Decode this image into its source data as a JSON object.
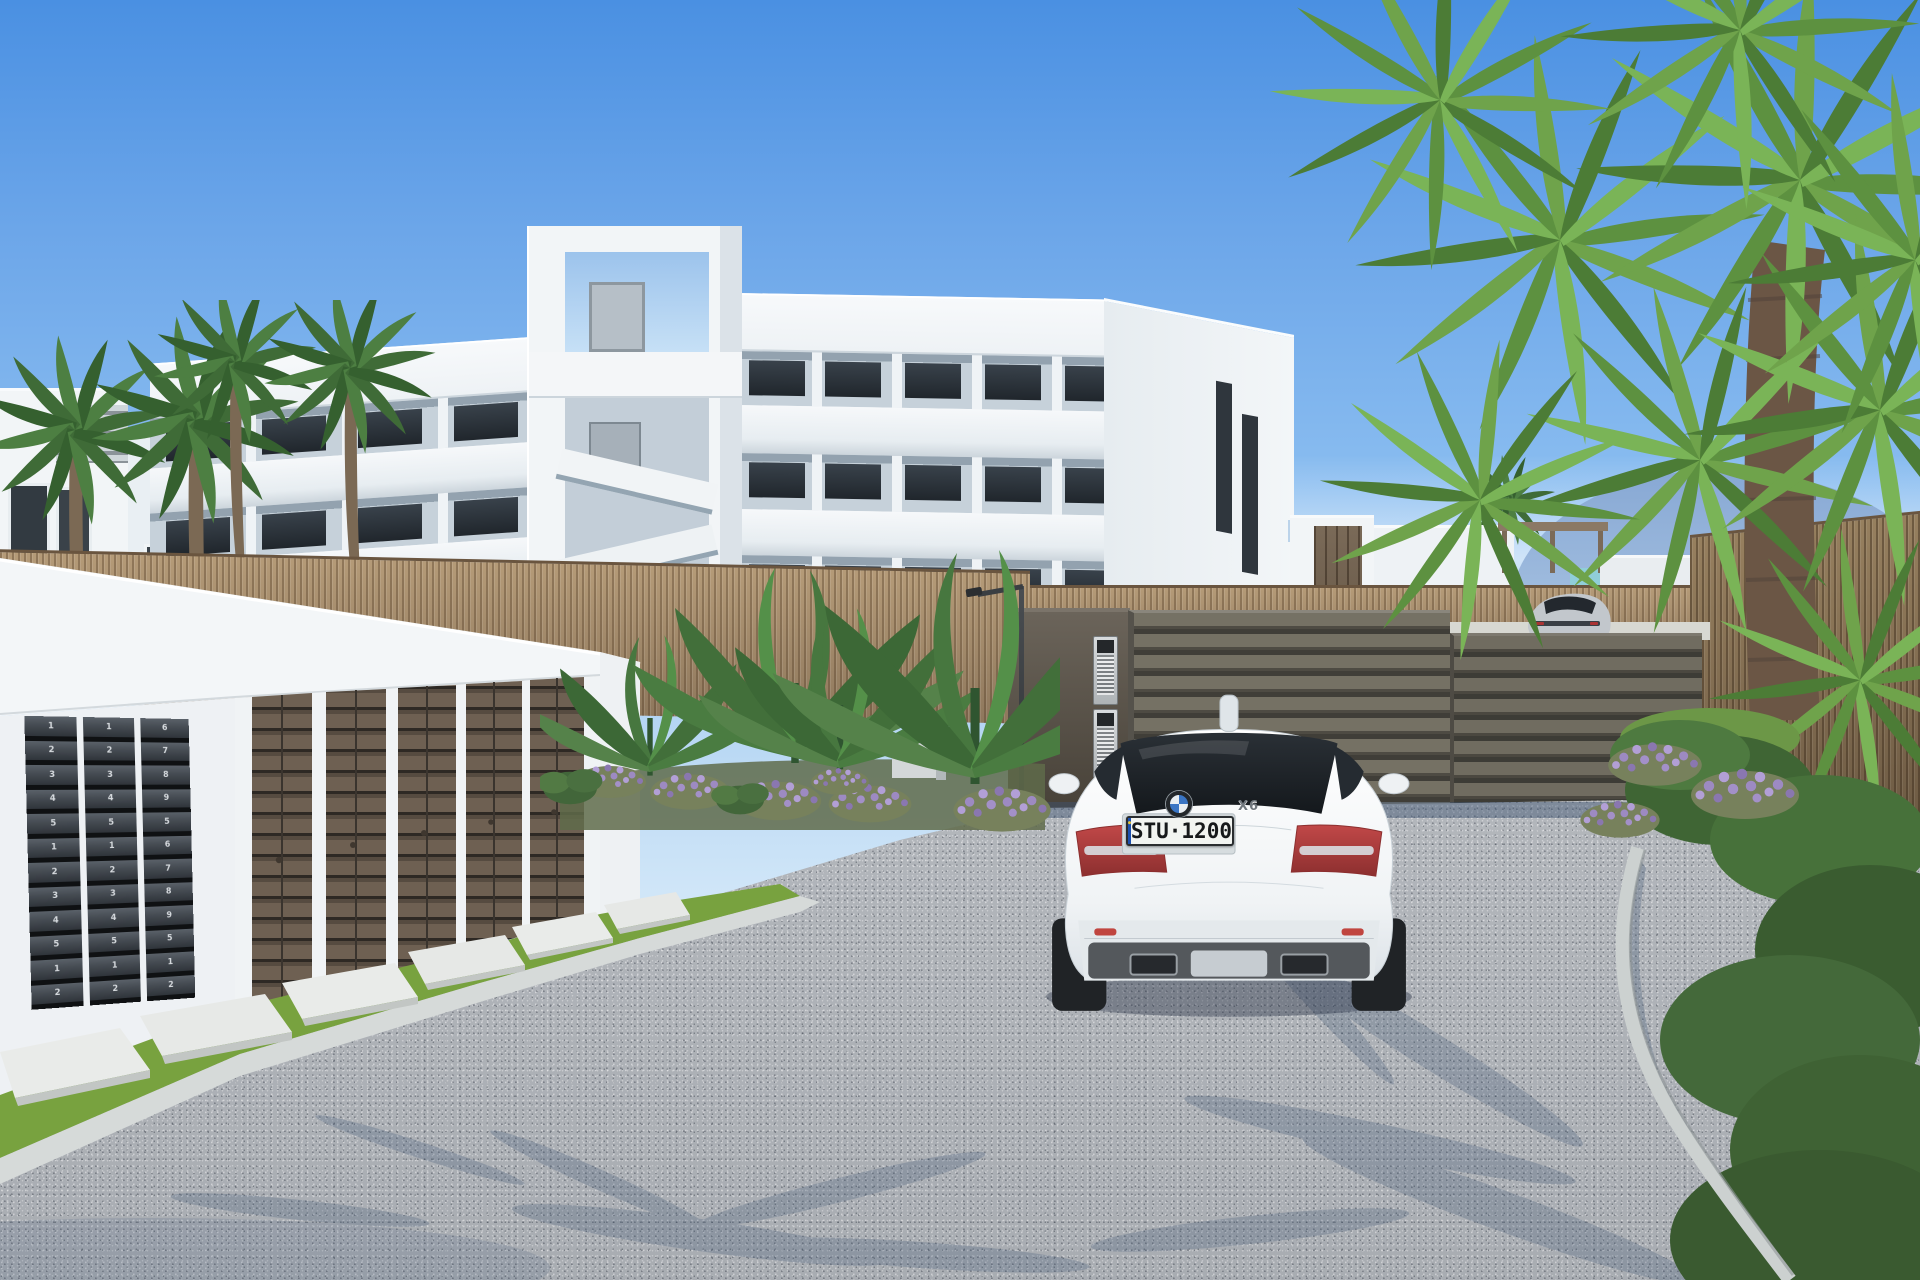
{
  "palette": {
    "sky_top": "#4a90e2",
    "sky_horizon": "#dcedfa",
    "building_white": "#f2f5f7",
    "balcony_shade": "#c6d1da",
    "window_glass": "#262d34",
    "reed_fence": "#a58b6a",
    "gate_slat": "#6e6a60",
    "garage_door": "#6e6052",
    "road": "#b7bbc0",
    "grass": "#78a23f",
    "palm_green": "#5d9140",
    "lavender": "#a08fc0",
    "mountain": "#87a8d4",
    "sea": "#8fd0d8",
    "curb": "#d6dad9",
    "mailbox": "#454b52",
    "shadow": "#3f5574",
    "plate_band": "#1c4fae",
    "taillight_red": "#b94040"
  },
  "vehicle": {
    "logo": "bmw-roundel",
    "model_badge": "X6",
    "license_plate": "STU·1200",
    "body_color": "#f2f5f7"
  },
  "background_vehicle": {
    "body_color": "#c2c7cc"
  },
  "mailboxes": {
    "columns": [
      [
        "1",
        "2",
        "3",
        "4",
        "5",
        "1",
        "2",
        "3",
        "4",
        "5",
        "1",
        "2"
      ],
      [
        "1",
        "2",
        "3",
        "4",
        "5",
        "1",
        "2",
        "3",
        "4",
        "5",
        "1",
        "2"
      ],
      [
        "6",
        "7",
        "8",
        "9",
        "5",
        "6",
        "7",
        "8",
        "9",
        "5",
        "1",
        "2"
      ]
    ]
  }
}
